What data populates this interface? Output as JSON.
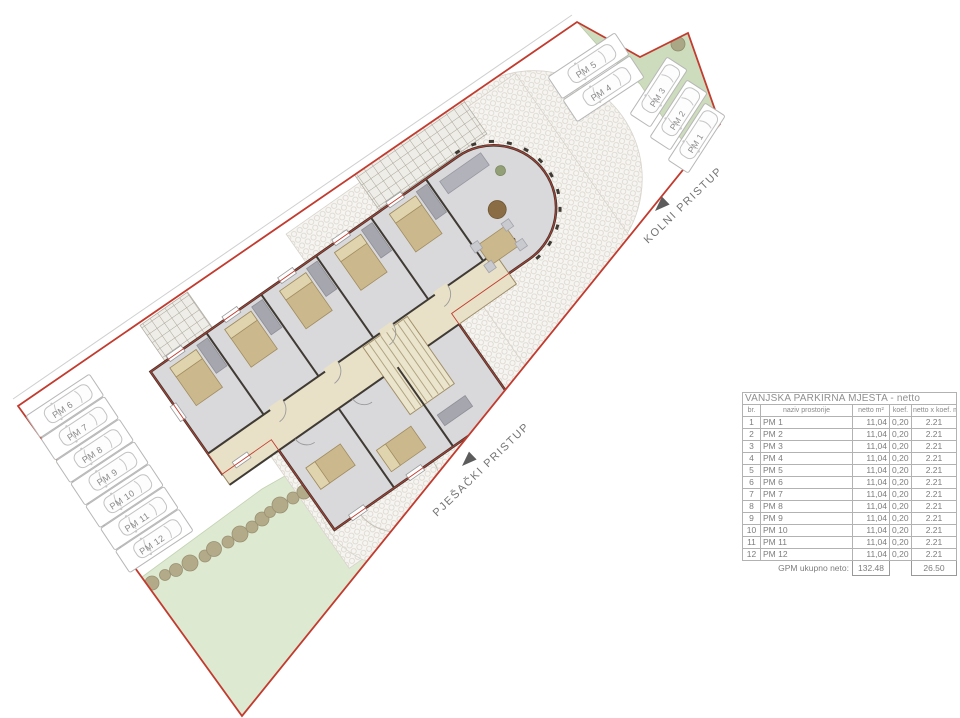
{
  "plan": {
    "road_labels": {
      "kolni": "KOLNI PRISTUP",
      "pjesacki": "PJEŠAČKI PRISTUP"
    },
    "stalls": [
      "PM 1",
      "PM 2",
      "PM 3",
      "PM 4",
      "PM 5",
      "PM 6",
      "PM 7",
      "PM 8",
      "PM 9",
      "PM 10",
      "PM 11",
      "PM 12"
    ]
  },
  "table": {
    "title": "VANJSKA PARKIRNA MJESTA - netto",
    "headers": {
      "br": "br.",
      "name": "naziv prostorije",
      "netto": "netto m²",
      "koef": "koef.",
      "result": "netto x koef. m²"
    },
    "rows": [
      {
        "br": "1",
        "name": "PM 1",
        "netto": "11,04",
        "koef": "0,20",
        "result": "2.21"
      },
      {
        "br": "2",
        "name": "PM 2",
        "netto": "11,04",
        "koef": "0,20",
        "result": "2.21"
      },
      {
        "br": "3",
        "name": "PM 3",
        "netto": "11,04",
        "koef": "0,20",
        "result": "2.21"
      },
      {
        "br": "4",
        "name": "PM 4",
        "netto": "11,04",
        "koef": "0,20",
        "result": "2.21"
      },
      {
        "br": "5",
        "name": "PM 5",
        "netto": "11,04",
        "koef": "0,20",
        "result": "2.21"
      },
      {
        "br": "6",
        "name": "PM 6",
        "netto": "11,04",
        "koef": "0,20",
        "result": "2.21"
      },
      {
        "br": "7",
        "name": "PM 7",
        "netto": "11,04",
        "koef": "0,20",
        "result": "2.21"
      },
      {
        "br": "8",
        "name": "PM 8",
        "netto": "11,04",
        "koef": "0,20",
        "result": "2.21"
      },
      {
        "br": "9",
        "name": "PM 9",
        "netto": "11,04",
        "koef": "0,20",
        "result": "2.21"
      },
      {
        "br": "10",
        "name": "PM 10",
        "netto": "11,04",
        "koef": "0,20",
        "result": "2.21"
      },
      {
        "br": "11",
        "name": "PM 11",
        "netto": "11,04",
        "koef": "0,20",
        "result": "2.21"
      },
      {
        "br": "12",
        "name": "PM 12",
        "netto": "11,04",
        "koef": "0,20",
        "result": "2.21"
      }
    ],
    "footer": {
      "label": "GPM ukupno neto:",
      "netto_total": "132.48",
      "result_total": "26.50"
    }
  },
  "colors": {
    "boundary_red": "#c23b2e",
    "lawn_green": "#dde9d1",
    "green_patch": "#ccdcbc",
    "bush": "#b0a88a",
    "pavement": "#f5f3ef",
    "building_floor": "#d9d9dc",
    "corridor_beige": "#e8e1c7",
    "furniture_tan": "#cbb88c",
    "wall_dark": "#3f3a33",
    "table_border": "#b2b2b2"
  }
}
